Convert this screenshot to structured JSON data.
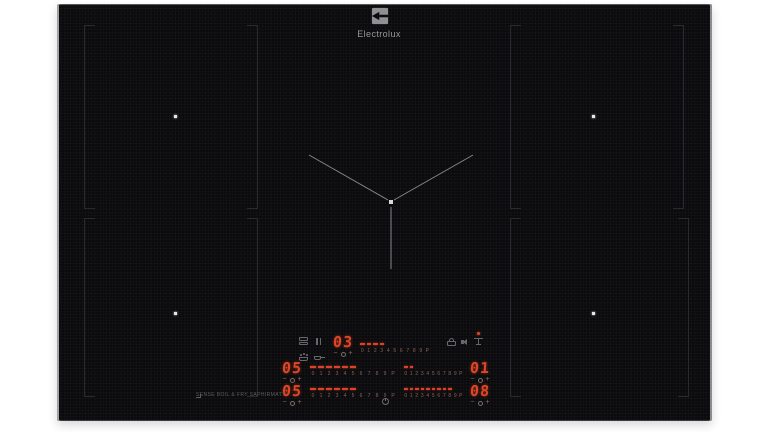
{
  "brand": {
    "name": "Electrolux"
  },
  "hob": {
    "model_label": "SENSE BOIL & FRY SAPHIRMATT",
    "scale": [
      "0",
      "1",
      "2",
      "3",
      "4",
      "5",
      "6",
      "7",
      "8",
      "9",
      "P"
    ],
    "displays": {
      "center": {
        "value": "03",
        "lit_segments": 4
      },
      "left_top": {
        "value": "05",
        "lit_segments": 6
      },
      "left_bottom": {
        "value": "05",
        "lit_segments": 6
      },
      "right_top": {
        "value": "01",
        "lit_segments": 2
      },
      "right_bottom": {
        "value": "08",
        "lit_segments": 9
      }
    },
    "controls": {
      "minus": "−",
      "plus": "+"
    },
    "colors": {
      "led_red": "#d8432a",
      "glass_black": "#0b0b0d",
      "marking_grey": "#8f9094"
    }
  }
}
